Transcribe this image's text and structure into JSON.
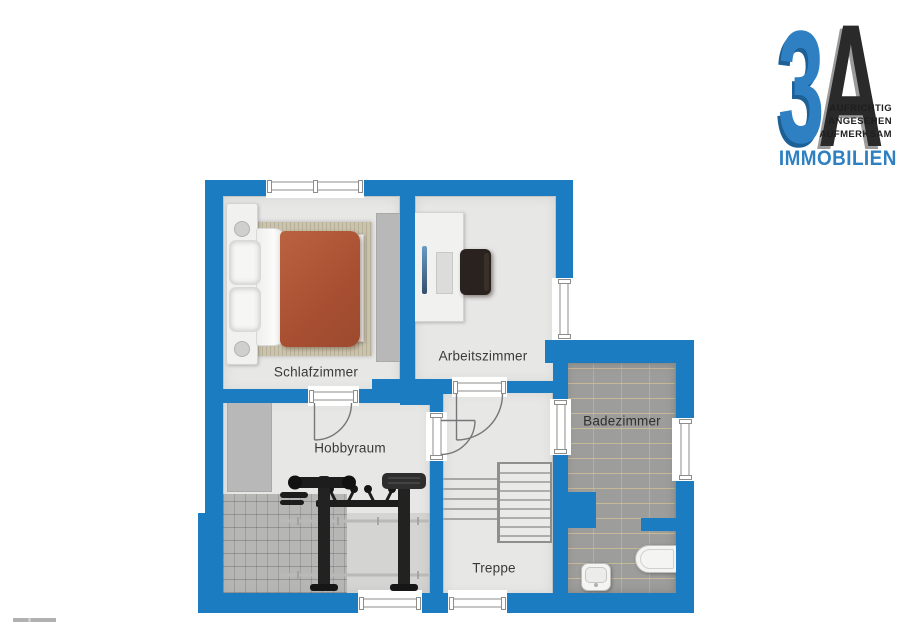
{
  "floorplan": {
    "rooms": {
      "bedroom": {
        "label": "Schlafzimmer"
      },
      "office": {
        "label": "Arbeitszimmer"
      },
      "hobby": {
        "label": "Hobbyraum"
      },
      "bathroom": {
        "label": "Badezimmer"
      },
      "stairs": {
        "label": "Treppe"
      }
    }
  },
  "logo": {
    "number": "3",
    "letter": "A",
    "tagline": [
      "AUFRICHTIG",
      "ANGESEHEN",
      "AUFMERKSAM"
    ],
    "brand": "IMMOBILIEN"
  },
  "colors": {
    "wall_blue": "#1b7cc1",
    "logo_blue": "#2e80c2",
    "logo_dark": "#2a2a2a",
    "floor_gray": "#e7e7e6",
    "tile_gray": "#9d9d9b",
    "blanket_terracotta": "#b05a3c",
    "rug_beige": "#cac3ad"
  }
}
